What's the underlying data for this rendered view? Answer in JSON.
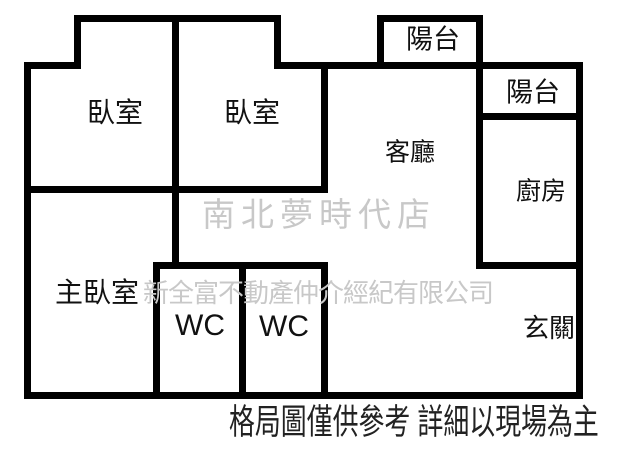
{
  "floor_plan": {
    "rooms": [
      {
        "id": "bedroom-1",
        "label": "臥室"
      },
      {
        "id": "bedroom-2",
        "label": "臥室"
      },
      {
        "id": "balcony-top",
        "label": "陽台"
      },
      {
        "id": "balcony-right",
        "label": "陽台"
      },
      {
        "id": "living-room",
        "label": "客廳"
      },
      {
        "id": "kitchen",
        "label": "廚房"
      },
      {
        "id": "master-bedroom",
        "label": "主臥室"
      },
      {
        "id": "wc-1",
        "label": "WC"
      },
      {
        "id": "wc-2",
        "label": "WC"
      },
      {
        "id": "entry-hall",
        "label": "玄關"
      }
    ],
    "store_watermark": "南北夢時代店",
    "agency_watermark": "新全富不動產仲介經紀有限公司",
    "caption": "格局圖僅供參考 詳細以現場為主",
    "colors": {
      "wall": "#000000",
      "label_text": "#111111",
      "watermark": "#c8c8c8",
      "caption_text": "#222222",
      "background": "#ffffff"
    }
  }
}
